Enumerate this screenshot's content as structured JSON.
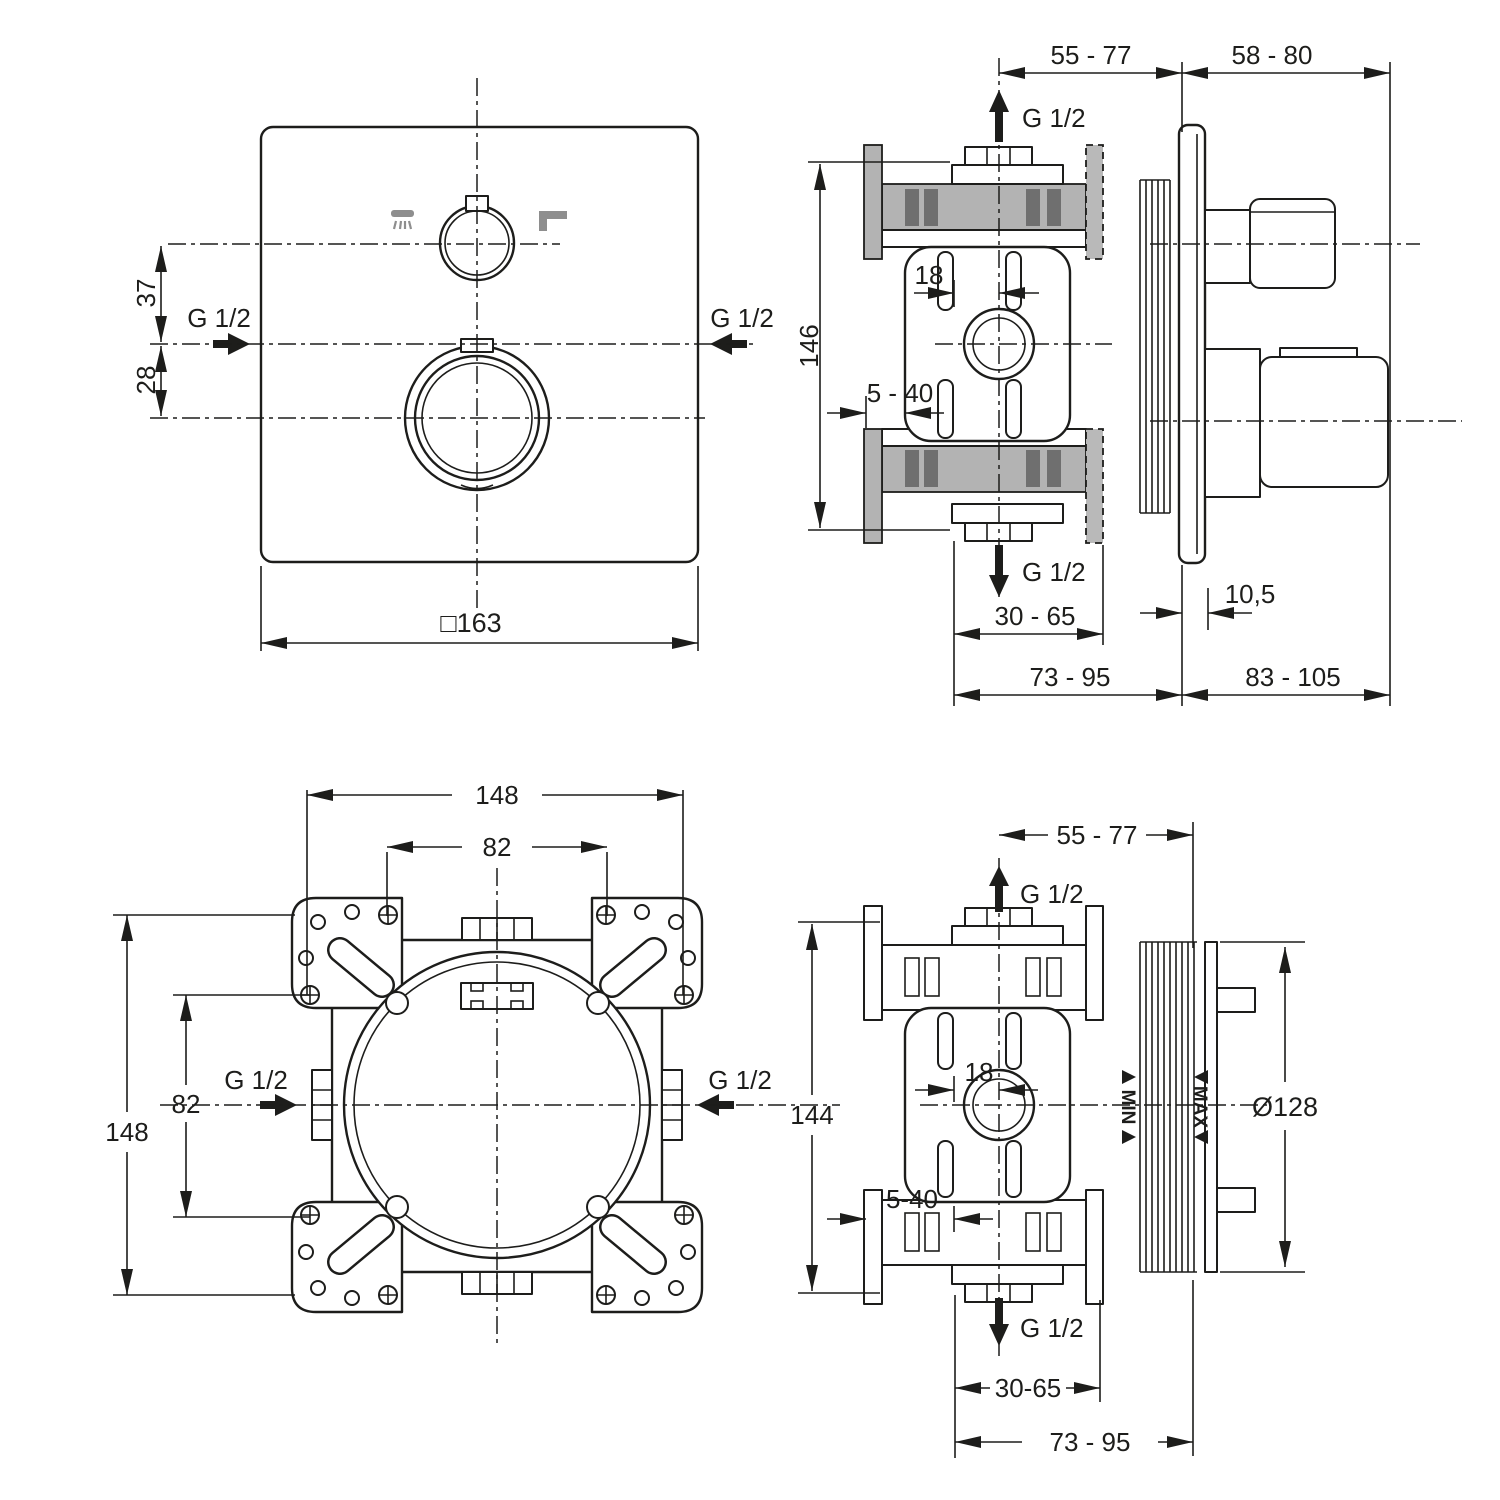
{
  "colors": {
    "line": "#1d1d1b",
    "wall_gray": "#b3b3b3",
    "wall_dark_gray": "#6f6f6f",
    "icon_gray": "#8e8e8e",
    "background": "#ffffff"
  },
  "views": {
    "trim_front": {
      "title": "front view - trim plate",
      "dim_37": "37",
      "dim_28": "28",
      "dim_size": "□163",
      "g_left": "G 1/2",
      "g_right": "G 1/2",
      "icons": [
        "hand-shower-icon",
        "spout-icon"
      ]
    },
    "trim_side": {
      "title": "side view - trim installed",
      "dim_55_77": "55 - 77",
      "dim_58_80": "58 - 80",
      "g_top": "G 1/2",
      "dim_146": "146",
      "dim_18": "18",
      "dim_5_40": "5 - 40",
      "g_bottom": "G 1/2",
      "dim_30_65": "30 - 65",
      "dim_10_5": "10,5",
      "dim_73_95": "73 - 95",
      "dim_83_105": "83 - 105"
    },
    "rough_front": {
      "title": "front view - rough-in box",
      "dim_top_148": "148",
      "dim_top_82": "82",
      "dim_left_148": "148",
      "dim_left_82": "82",
      "g_left": "G 1/2",
      "g_right": "G 1/2"
    },
    "rough_side": {
      "title": "side view - rough-in box",
      "dim_55_77": "55 - 77",
      "g_top": "G 1/2",
      "dim_144": "144",
      "dim_18": "18",
      "dim_5_40": "5-40",
      "min_label": "MIN",
      "max_label": "MAX",
      "dim_dia": "Ø128",
      "g_bottom": "G 1/2",
      "dim_30_65": "30-65",
      "dim_73_95": "73 - 95"
    }
  }
}
